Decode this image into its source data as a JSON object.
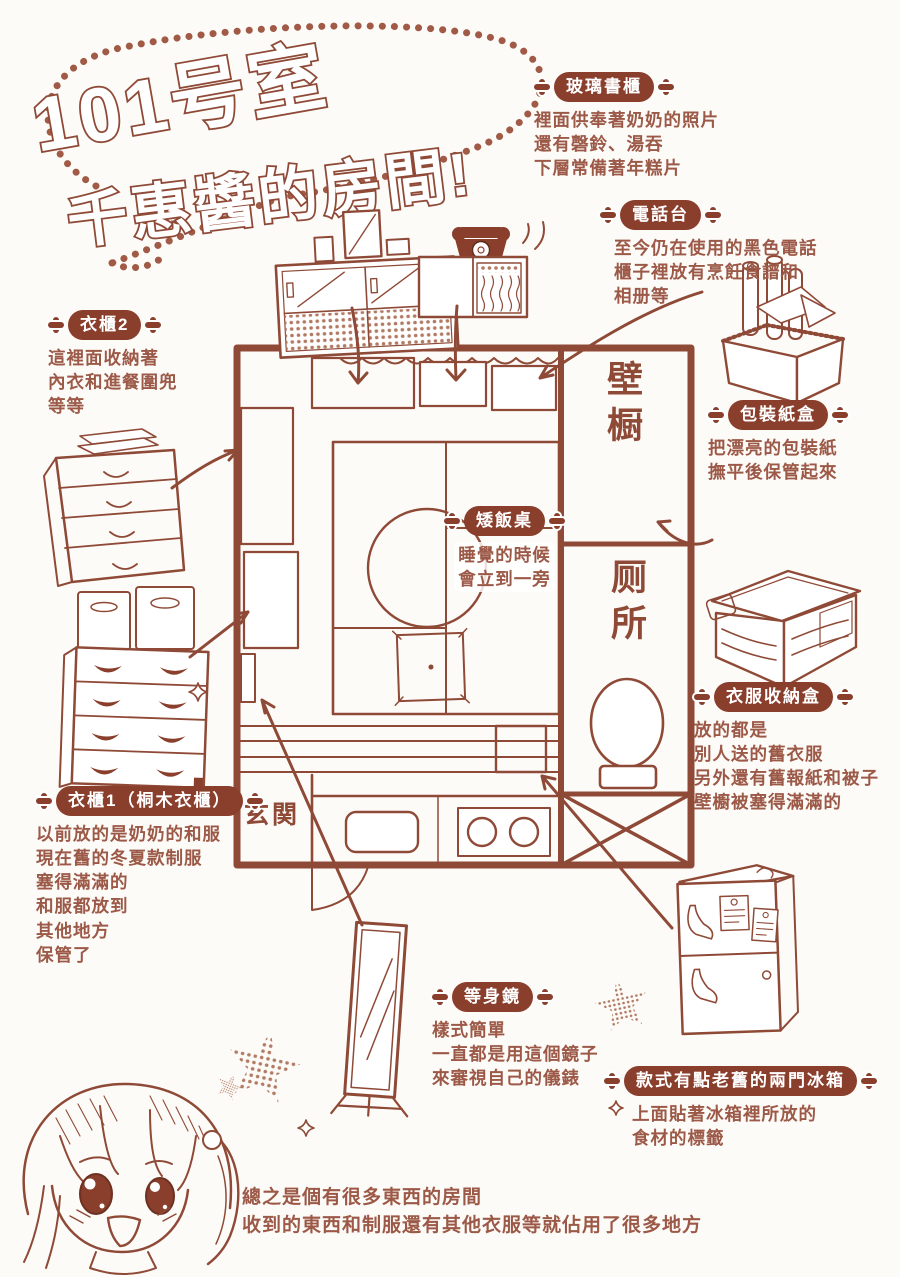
{
  "page": {
    "title_line1": "101号室",
    "title_line2": "千惠醬的房間!",
    "footer_lines": [
      "總之是個有很多東西的房間",
      "收到的東西和制服還有其他衣服等就佔用了很多地方"
    ]
  },
  "floorplan": {
    "labels": {
      "closet": "壁橱",
      "toilet": "厕所",
      "entrance": "玄関"
    }
  },
  "sections": {
    "glass_bookcase": {
      "label": "玻璃書櫃",
      "lines": [
        "裡面供奉著奶奶的照片",
        "還有磬鈴、湯吞",
        "下層常備著年糕片"
      ]
    },
    "phone_stand": {
      "label": "電話台",
      "lines": [
        "至今仍在使用的黑色電話",
        "櫃子裡放有烹飪食譜和",
        "相册等"
      ]
    },
    "wardrobe2": {
      "label": "衣櫃2",
      "lines": [
        "這裡面收納著",
        "內衣和進餐圍兜",
        "等等"
      ]
    },
    "wrapping_paper_box": {
      "label": "包裝紙盒",
      "lines": [
        "把漂亮的包裝紙",
        "撫平後保管起來"
      ]
    },
    "low_table": {
      "label": "矮飯桌",
      "lines": [
        "睡覺的時候",
        "會立到一旁"
      ]
    },
    "clothes_storage_box": {
      "label": "衣服收納盒",
      "lines": [
        "放的都是",
        "別人送的舊衣服",
        "另外還有舊報紙和被子",
        "壁櫥被塞得滿滿的"
      ]
    },
    "wardrobe1": {
      "label": "衣櫃1（桐木衣櫃）",
      "lines": [
        "以前放的是奶奶的和服",
        "現在舊的冬夏款制服",
        "塞得滿滿的",
        "和服都放到",
        "其他地方",
        "保管了"
      ]
    },
    "full_length_mirror": {
      "label": "等身鏡",
      "lines": [
        "樣式簡單",
        "一直都是用這個鏡子",
        "來審視自己的儀錶"
      ]
    },
    "fridge": {
      "label": "款式有點老舊的兩門冰箱",
      "lines": [
        "上面貼著冰箱裡所放的",
        "食材的標籤"
      ]
    }
  },
  "icons": {
    "badge_decoration": "four-petal-cross",
    "style": "hand-drawn-red-brown-manga"
  },
  "colors": {
    "line": "#8f4a37",
    "badge_background": "#8a3e2c",
    "body_text": "#9c5947",
    "background": "#fdfbf8"
  }
}
